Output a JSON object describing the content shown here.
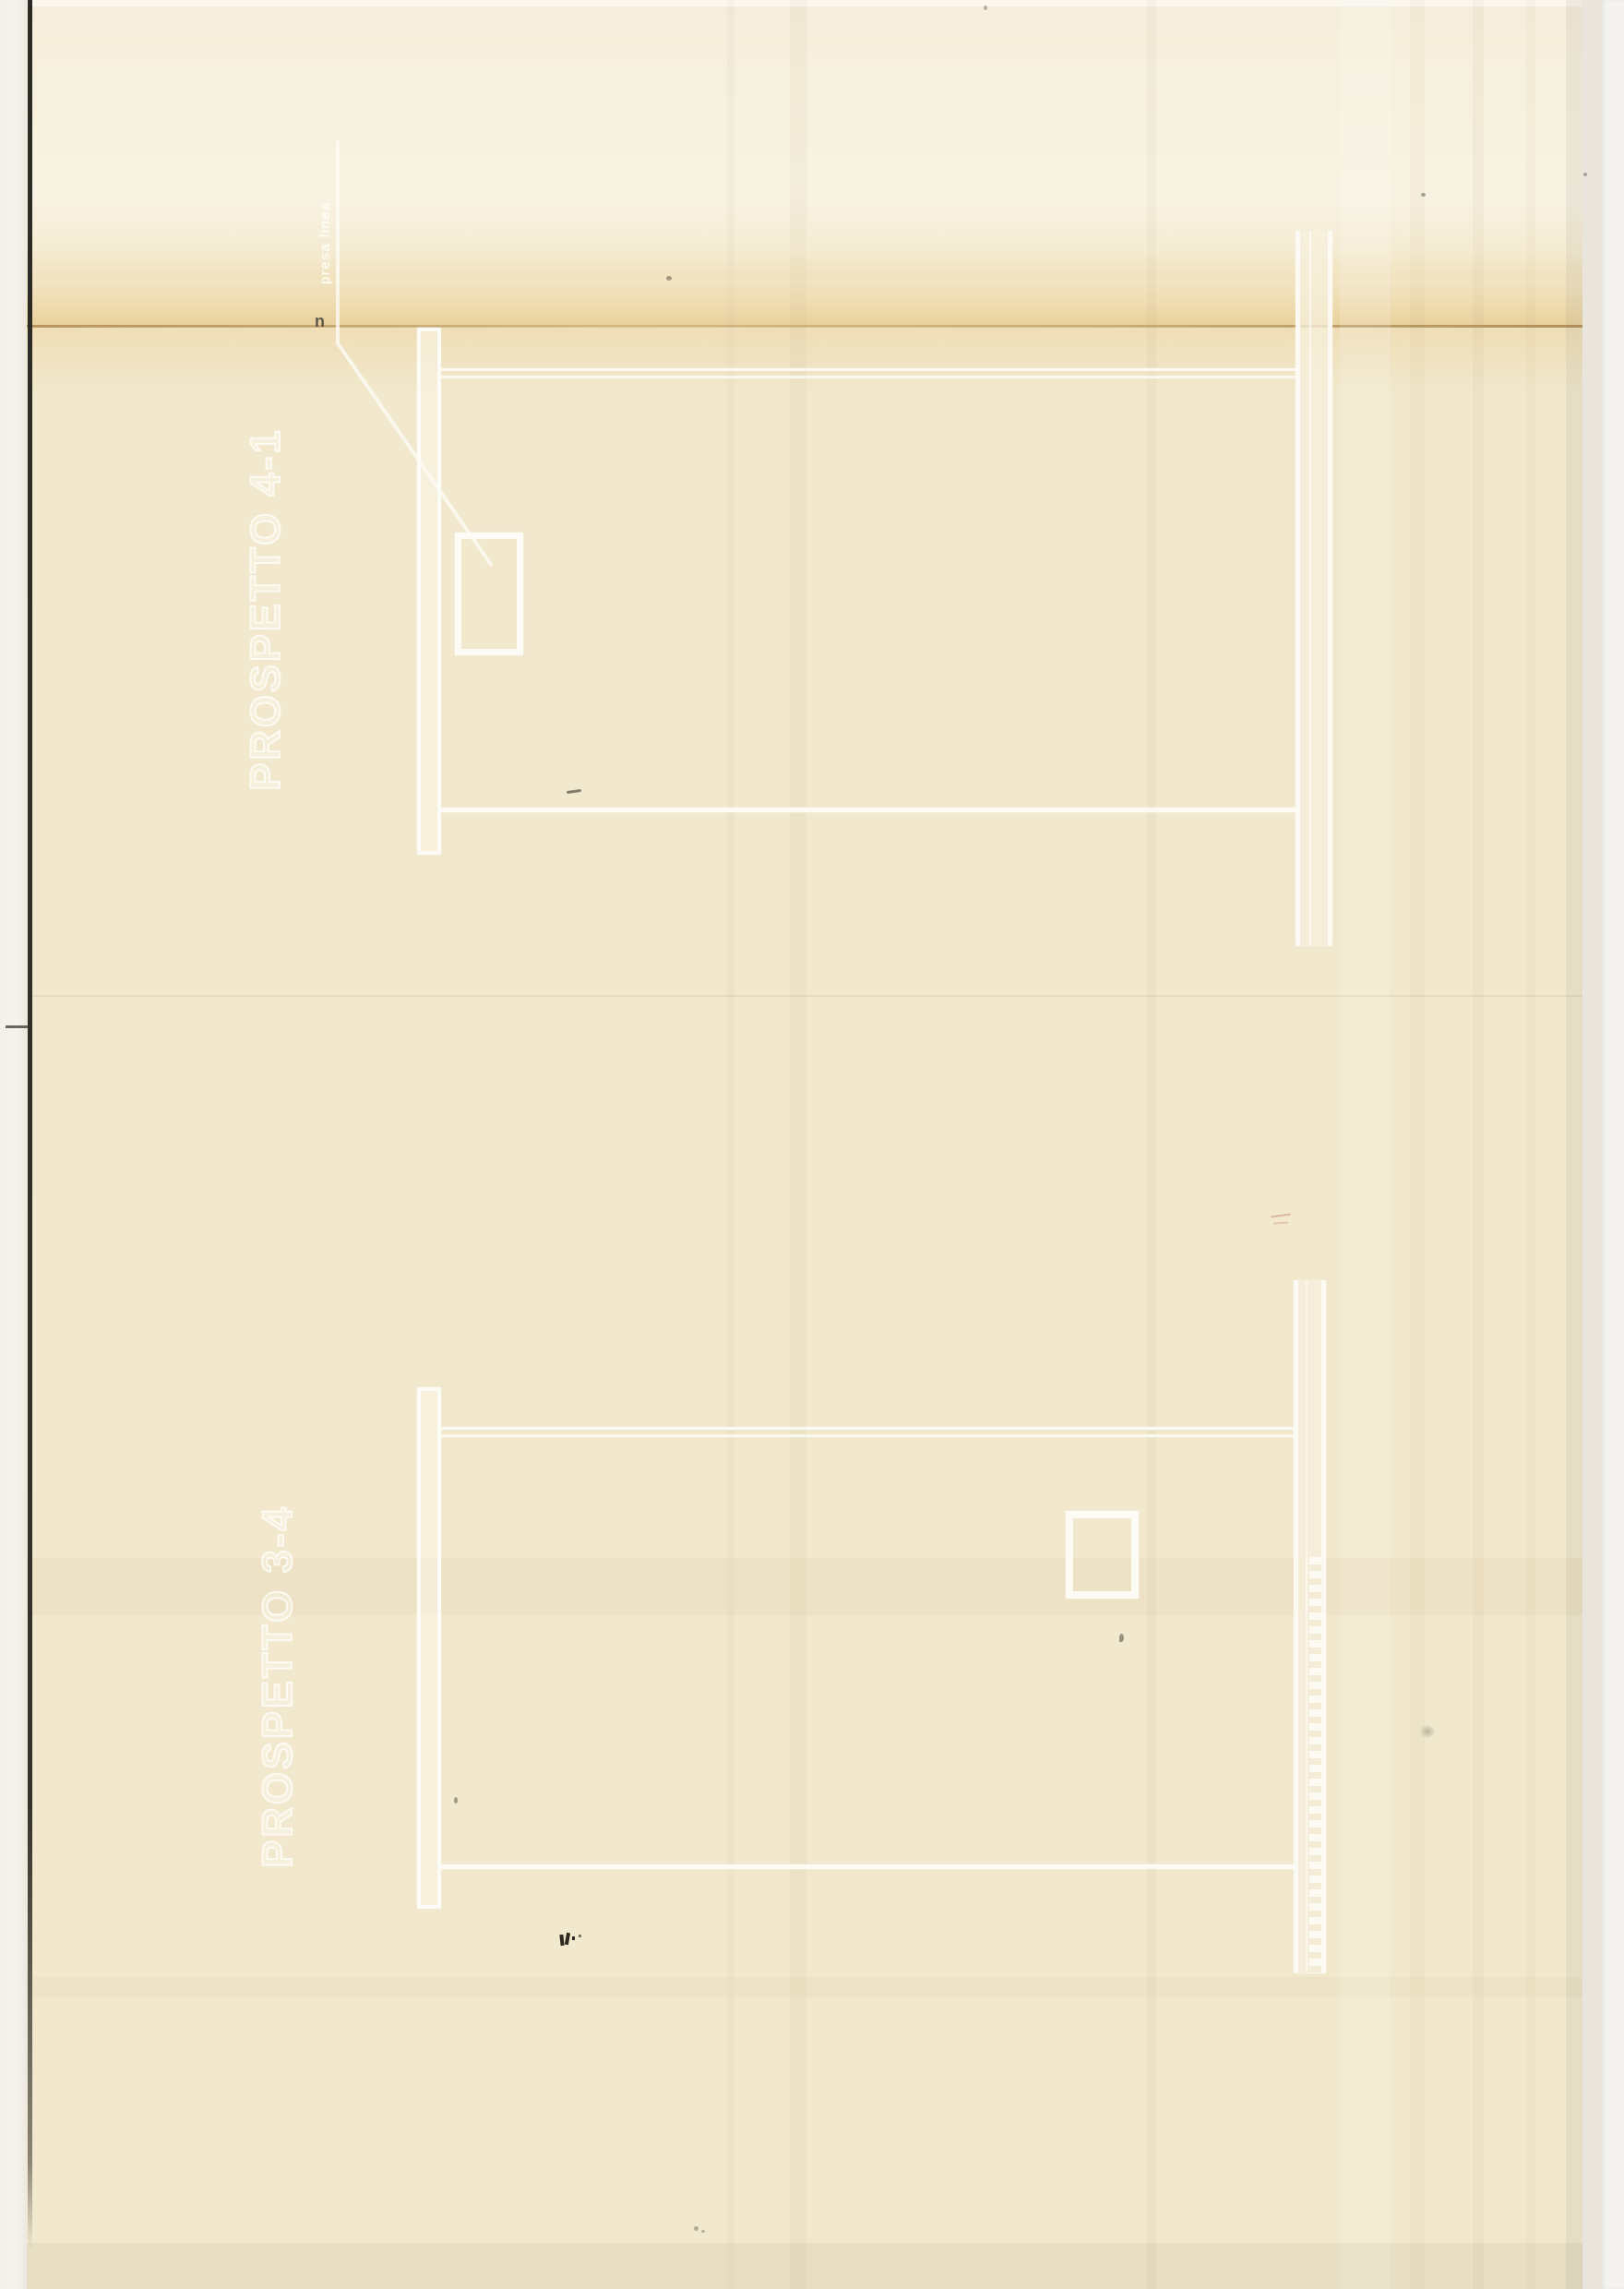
{
  "drawings": {
    "top": {
      "title": "PROSPETTO  4-1",
      "annotation": "presa linea",
      "annotation_prefix": "n"
    },
    "bottom": {
      "title": "PROSPETTO  3-4"
    }
  },
  "colors": {
    "paper": "#f1e8cd",
    "drawing_line": "#fdfcf7",
    "fold_crease": "#a5793e",
    "scan_edge_black": "#302e29",
    "right_edge_gray": "#e9e5dc"
  }
}
